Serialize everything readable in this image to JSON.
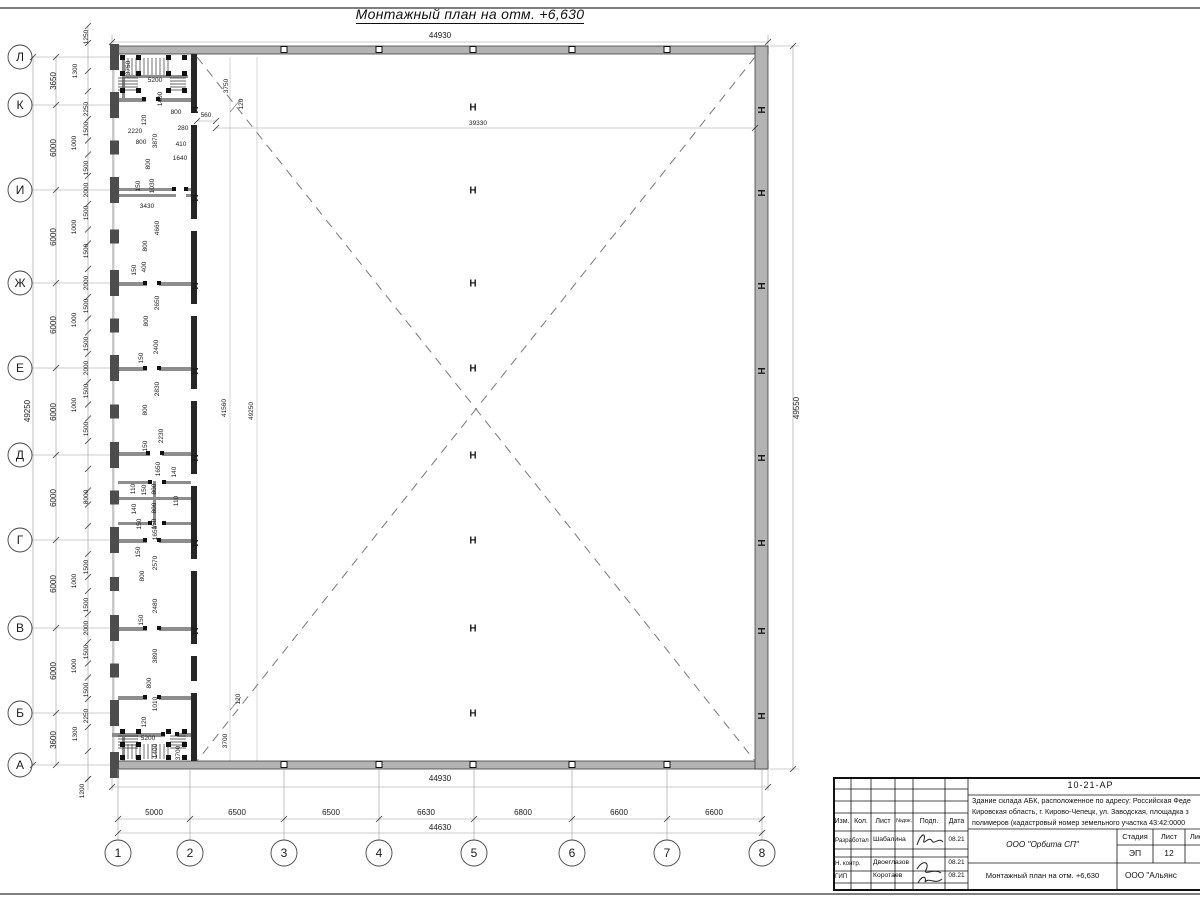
{
  "page": {
    "title": "Монтажный план на отм. +6,630"
  },
  "plan": {
    "row_axes": [
      {
        "label": "Л",
        "y": 57
      },
      {
        "label": "К",
        "y": 105
      },
      {
        "label": "И",
        "y": 190
      },
      {
        "label": "Ж",
        "y": 283
      },
      {
        "label": "Е",
        "y": 368
      },
      {
        "label": "Д",
        "y": 455
      },
      {
        "label": "Г",
        "y": 540
      },
      {
        "label": "В",
        "y": 628
      },
      {
        "label": "Б",
        "y": 713
      },
      {
        "label": "А",
        "y": 765
      }
    ],
    "col_axes": [
      {
        "label": "1",
        "x": 118
      },
      {
        "label": "2",
        "x": 190
      },
      {
        "label": "3",
        "x": 284
      },
      {
        "label": "4",
        "x": 379
      },
      {
        "label": "5",
        "x": 474
      },
      {
        "label": "6",
        "x": 572
      },
      {
        "label": "7",
        "x": 667
      },
      {
        "label": "8",
        "x": 762
      }
    ],
    "row_spacing": [
      "3650",
      "6000",
      "6000",
      "6000",
      "6000",
      "6000",
      "6000",
      "6000",
      "3600"
    ],
    "col_spacing": [
      "5000",
      "6500",
      "6500",
      "6630",
      "6800",
      "6600",
      "6600"
    ],
    "columns": {
      "grid5_y": [
        107,
        190,
        283,
        368,
        455,
        540,
        628,
        713
      ],
      "right_wall_y": [
        107,
        190,
        283,
        368,
        455,
        540,
        628,
        713
      ],
      "inner_wall_y": [
        107,
        195,
        283,
        368,
        455,
        540,
        628
      ],
      "wall_squares_x": [
        284,
        379,
        473,
        572,
        667
      ]
    },
    "dim_labels": [
      {
        "t": "44930",
        "x": 440,
        "y": 38,
        "s": 8
      },
      {
        "t": "39330",
        "x": 478,
        "y": 125
      },
      {
        "t": "560",
        "x": 206,
        "y": 117
      },
      {
        "t": "3750",
        "x": 228,
        "y": 86,
        "r": 1
      },
      {
        "t": "120",
        "x": 243,
        "y": 104,
        "r": 1
      },
      {
        "t": "41560",
        "x": 226,
        "y": 408,
        "r": 1
      },
      {
        "t": "49250",
        "x": 253,
        "y": 411,
        "r": 1
      },
      {
        "t": "120",
        "x": 240,
        "y": 699,
        "r": 1
      },
      {
        "t": "3700",
        "x": 227,
        "y": 741,
        "r": 1
      },
      {
        "t": "49550",
        "x": 799,
        "y": 408,
        "r": 1,
        "s": 8
      },
      {
        "t": "49250",
        "x": 30,
        "y": 411,
        "r": 1,
        "s": 8
      },
      {
        "t": "3650",
        "x": 56,
        "y": 81,
        "r": 1,
        "s": 8
      },
      {
        "t": "6000",
        "x": 56,
        "y": 148,
        "r": 1,
        "s": 8
      },
      {
        "t": "6000",
        "x": 56,
        "y": 237,
        "r": 1,
        "s": 8
      },
      {
        "t": "6000",
        "x": 56,
        "y": 325,
        "r": 1,
        "s": 8
      },
      {
        "t": "6000",
        "x": 56,
        "y": 412,
        "r": 1,
        "s": 8
      },
      {
        "t": "6000",
        "x": 56,
        "y": 498,
        "r": 1,
        "s": 8
      },
      {
        "t": "6000",
        "x": 56,
        "y": 584,
        "r": 1,
        "s": 8
      },
      {
        "t": "6000",
        "x": 56,
        "y": 671,
        "r": 1,
        "s": 8
      },
      {
        "t": "3600",
        "x": 56,
        "y": 740,
        "r": 1,
        "s": 8
      },
      {
        "t": "1250",
        "x": 88,
        "y": 37,
        "r": 1
      },
      {
        "t": "1300",
        "x": 77,
        "y": 71,
        "r": 1
      },
      {
        "t": "2250",
        "x": 88,
        "y": 109,
        "r": 1
      },
      {
        "t": "1500",
        "x": 88,
        "y": 129,
        "r": 1
      },
      {
        "t": "1000",
        "x": 76,
        "y": 143,
        "r": 1
      },
      {
        "t": "1500",
        "x": 88,
        "y": 168,
        "r": 1
      },
      {
        "t": "2000",
        "x": 88,
        "y": 190,
        "r": 1
      },
      {
        "t": "1500",
        "x": 88,
        "y": 213,
        "r": 1
      },
      {
        "t": "1000",
        "x": 76,
        "y": 227,
        "r": 1
      },
      {
        "t": "1500",
        "x": 88,
        "y": 251,
        "r": 1
      },
      {
        "t": "2000",
        "x": 88,
        "y": 283,
        "r": 1
      },
      {
        "t": "1500",
        "x": 88,
        "y": 306,
        "r": 1
      },
      {
        "t": "1000",
        "x": 76,
        "y": 320,
        "r": 1
      },
      {
        "t": "1500",
        "x": 88,
        "y": 344,
        "r": 1
      },
      {
        "t": "2000",
        "x": 88,
        "y": 368,
        "r": 1
      },
      {
        "t": "1500",
        "x": 88,
        "y": 391,
        "r": 1
      },
      {
        "t": "1000",
        "x": 76,
        "y": 405,
        "r": 1
      },
      {
        "t": "1500",
        "x": 88,
        "y": 429,
        "r": 1
      },
      {
        "t": "8000",
        "x": 88,
        "y": 497,
        "r": 1
      },
      {
        "t": "1500",
        "x": 88,
        "y": 567,
        "r": 1
      },
      {
        "t": "1000",
        "x": 76,
        "y": 581,
        "r": 1
      },
      {
        "t": "1500",
        "x": 88,
        "y": 605,
        "r": 1
      },
      {
        "t": "2000",
        "x": 88,
        "y": 628,
        "r": 1
      },
      {
        "t": "1500",
        "x": 88,
        "y": 652,
        "r": 1
      },
      {
        "t": "1000",
        "x": 76,
        "y": 666,
        "r": 1
      },
      {
        "t": "1500",
        "x": 88,
        "y": 690,
        "r": 1
      },
      {
        "t": "2250",
        "x": 88,
        "y": 716,
        "r": 1
      },
      {
        "t": "1300",
        "x": 77,
        "y": 734,
        "r": 1
      },
      {
        "t": "1200",
        "x": 84,
        "y": 791,
        "r": 1
      },
      {
        "t": "5000",
        "x": 154,
        "y": 815,
        "s": 8
      },
      {
        "t": "6500",
        "x": 237,
        "y": 815,
        "s": 8
      },
      {
        "t": "6500",
        "x": 331,
        "y": 815,
        "s": 8
      },
      {
        "t": "6630",
        "x": 426,
        "y": 815,
        "s": 8
      },
      {
        "t": "6800",
        "x": 523,
        "y": 815,
        "s": 8
      },
      {
        "t": "6600",
        "x": 619,
        "y": 815,
        "s": 8
      },
      {
        "t": "6600",
        "x": 714,
        "y": 815,
        "s": 8
      },
      {
        "t": "44930",
        "x": 440,
        "y": 781,
        "s": 8
      },
      {
        "t": "44630",
        "x": 440,
        "y": 830,
        "s": 8
      },
      {
        "t": "3750",
        "x": 130,
        "y": 68,
        "r": 1
      },
      {
        "t": "5200",
        "x": 155,
        "y": 82
      },
      {
        "t": "1400",
        "x": 162,
        "y": 99,
        "r": 1
      },
      {
        "t": "120",
        "x": 146,
        "y": 120,
        "r": 1
      },
      {
        "t": "2220",
        "x": 135,
        "y": 133
      },
      {
        "t": "800",
        "x": 141,
        "y": 144
      },
      {
        "t": "3870",
        "x": 157,
        "y": 141,
        "r": 1
      },
      {
        "t": "800",
        "x": 176,
        "y": 114
      },
      {
        "t": "280",
        "x": 183,
        "y": 130
      },
      {
        "t": "410",
        "x": 181,
        "y": 146
      },
      {
        "t": "1640",
        "x": 180,
        "y": 160
      },
      {
        "t": "800",
        "x": 150,
        "y": 164,
        "r": 1
      },
      {
        "t": "150",
        "x": 140,
        "y": 186,
        "r": 1
      },
      {
        "t": "1030",
        "x": 154,
        "y": 186,
        "r": 1
      },
      {
        "t": "3430",
        "x": 147,
        "y": 208
      },
      {
        "t": "4660",
        "x": 159,
        "y": 228,
        "r": 1
      },
      {
        "t": "800",
        "x": 147,
        "y": 246,
        "r": 1
      },
      {
        "t": "400",
        "x": 146,
        "y": 267,
        "r": 1
      },
      {
        "t": "150",
        "x": 136,
        "y": 270,
        "r": 1
      },
      {
        "t": "2650",
        "x": 159,
        "y": 303,
        "r": 1
      },
      {
        "t": "800",
        "x": 148,
        "y": 321,
        "r": 1
      },
      {
        "t": "2400",
        "x": 158,
        "y": 347,
        "r": 1
      },
      {
        "t": "150",
        "x": 143,
        "y": 358,
        "r": 1
      },
      {
        "t": "2830",
        "x": 159,
        "y": 389,
        "r": 1
      },
      {
        "t": "800",
        "x": 147,
        "y": 410,
        "r": 1
      },
      {
        "t": "2230",
        "x": 163,
        "y": 436,
        "r": 1
      },
      {
        "t": "150",
        "x": 147,
        "y": 446,
        "r": 1
      },
      {
        "t": "1650",
        "x": 160,
        "y": 469,
        "r": 1
      },
      {
        "t": "140",
        "x": 176,
        "y": 472,
        "r": 1
      },
      {
        "t": "110",
        "x": 135,
        "y": 489,
        "r": 1
      },
      {
        "t": "150",
        "x": 146,
        "y": 490,
        "r": 1
      },
      {
        "t": "800",
        "x": 156,
        "y": 489,
        "r": 1
      },
      {
        "t": "800",
        "x": 156,
        "y": 508,
        "r": 1
      },
      {
        "t": "110",
        "x": 178,
        "y": 501,
        "r": 1
      },
      {
        "t": "140",
        "x": 136,
        "y": 509,
        "r": 1
      },
      {
        "t": "150",
        "x": 141,
        "y": 524,
        "r": 1
      },
      {
        "t": "150",
        "x": 156,
        "y": 524,
        "r": 1
      },
      {
        "t": "1650",
        "x": 157,
        "y": 533,
        "r": 1
      },
      {
        "t": "150",
        "x": 140,
        "y": 552,
        "r": 1
      },
      {
        "t": "2570",
        "x": 157,
        "y": 563,
        "r": 1
      },
      {
        "t": "800",
        "x": 144,
        "y": 576,
        "r": 1
      },
      {
        "t": "2480",
        "x": 157,
        "y": 606,
        "r": 1
      },
      {
        "t": "150",
        "x": 143,
        "y": 620,
        "r": 1
      },
      {
        "t": "3890",
        "x": 157,
        "y": 656,
        "r": 1
      },
      {
        "t": "800",
        "x": 151,
        "y": 683,
        "r": 1
      },
      {
        "t": "1010",
        "x": 157,
        "y": 704,
        "r": 1
      },
      {
        "t": "120",
        "x": 146,
        "y": 722,
        "r": 1
      },
      {
        "t": "5200",
        "x": 148,
        "y": 740
      },
      {
        "t": "1400",
        "x": 157,
        "y": 751,
        "r": 1
      },
      {
        "t": "3700",
        "x": 180,
        "y": 753,
        "r": 1
      }
    ]
  },
  "titleblock": {
    "doc_number": "10-21-АР",
    "description_lines": [
      "Здание склада АБК, расположенное по адресу: Российская Феде",
      "Кировская область, г. Кирово-Чепецк, ул. Заводская, площадка з",
      "полимеров (кадастровый номер земельного участка 43:42:0000"
    ],
    "columns": {
      "izm": "Изм.",
      "kol": "Кол.",
      "list": "Лист",
      "ndoc": "№док.",
      "podp": "Подп.",
      "data": "Дата"
    },
    "rows": [
      {
        "role": "Разработал",
        "name": "Шабалина",
        "date": "08.21"
      },
      {
        "role": "Н. контр.",
        "name": "Двоеглазов",
        "date": "08.21"
      },
      {
        "role": "ГИП",
        "name": "Коротаев",
        "date": "08.21"
      }
    ],
    "stage_header": {
      "stage": "Стадия",
      "sheet": "Лист",
      "sheets": "Листов"
    },
    "stage_values": {
      "stage": "ЭП",
      "sheet": "12",
      "sheets": "1"
    },
    "org": "ООО \"Орбита СП\"",
    "sheet_title": "Монтажный план на отм. +6,630",
    "org2": "ООО \"Альянс"
  }
}
